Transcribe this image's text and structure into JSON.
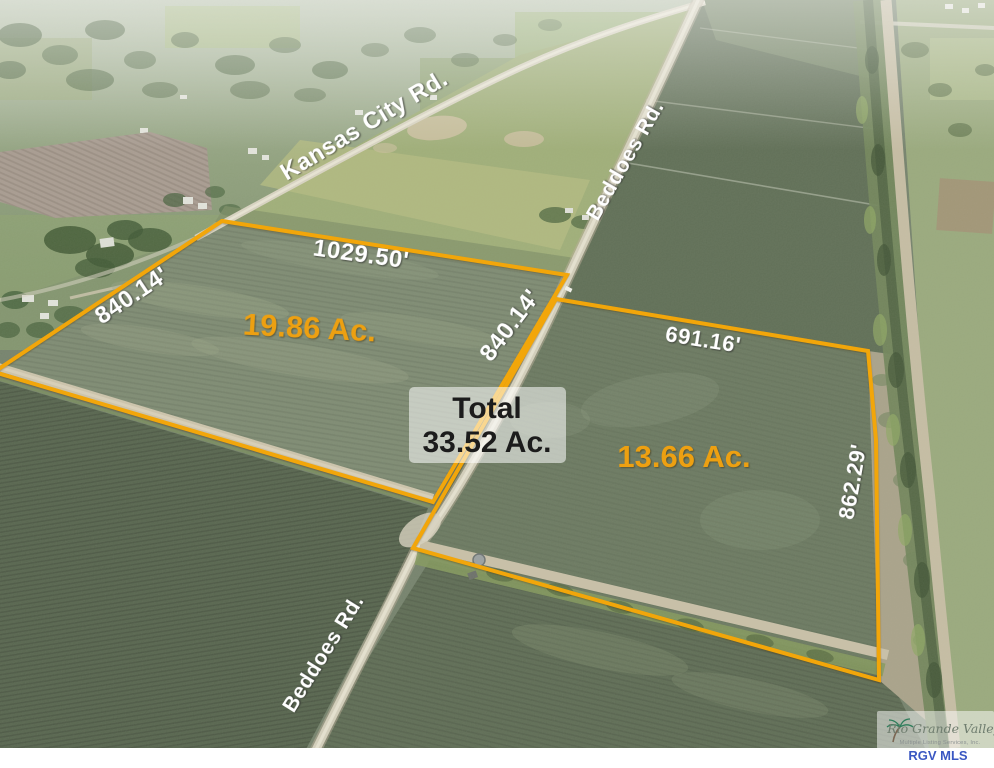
{
  "roads": {
    "kansas_city_label": "Kansas City Rd.",
    "beddoes_upper_label": "Beddoes Rd.",
    "beddoes_lower_label": "Beddoes Rd."
  },
  "parcels": {
    "outline_color": "#F2A60A",
    "acreage_color": "#EDA011",
    "left": {
      "acreage": "19.86 Ac.",
      "top_length": "1029.50'",
      "west_length": "840.14'",
      "east_length": "840.14'"
    },
    "right": {
      "acreage": "13.66 Ac.",
      "north_length": "691.16'",
      "east_length": "862.29'"
    }
  },
  "total_callout": {
    "label": "Total",
    "value": "33.52 Ac."
  },
  "watermark": {
    "brand": "Rio Grande Valley",
    "subtitle": "Multiple Listing Services, Inc.",
    "abbr": "RGV MLS",
    "abbr_color": "#3A57C2"
  }
}
